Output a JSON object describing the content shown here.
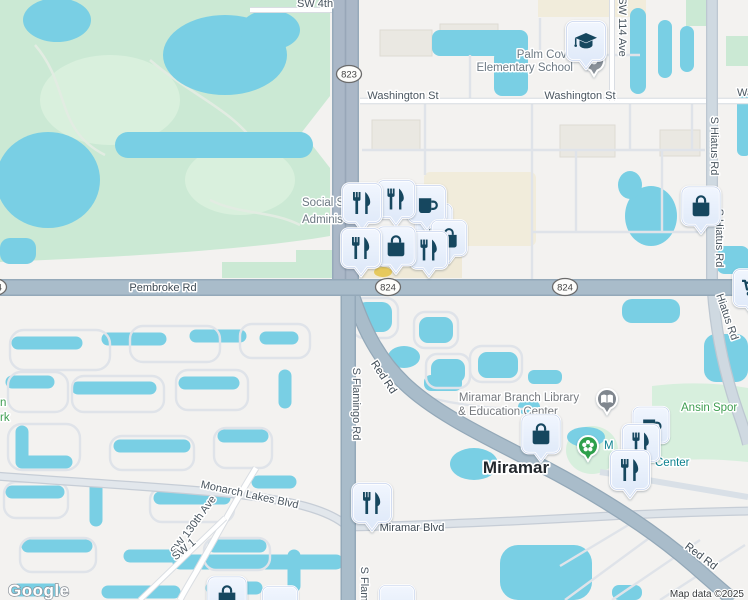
{
  "map": {
    "logo": "Google",
    "attribution": "Map data ©2025",
    "city_label": "Miramar",
    "shields": {
      "route_823": "823",
      "route_824_a": "824",
      "route_824_b": "824",
      "route_824_edge": "824"
    },
    "street_labels": {
      "sw_4th": "SW 4th",
      "washington_st_a": "Washington St",
      "washington_st_b": "Washington St",
      "washington_st_edge": "Was",
      "sw_114_ave": "SW 114 Ave",
      "s_hiatus_rd_a": "S Hiatus Rd",
      "s_hiatus_rd_b": "S Hiatus Rd",
      "hiatus_rd": "Hiatus Rd",
      "pembroke_rd": "Pembroke Rd",
      "s_flamingo_rd": "S Flamingo Rd",
      "s_flamingo_rd_edge": "S Flam",
      "red_rd_a": "Red Rd",
      "red_rd_b": "Red Rd",
      "monarch_lakes_blvd": "Monarch Lakes Blvd",
      "sw_130th_ave": "SW 130th Ave",
      "sw_1_edge": "SW 1",
      "miramar_blvd": "Miramar Blvd"
    },
    "poi_labels": {
      "palm_cove_line1": "Palm Cove",
      "palm_cove_line2": "Elementary School",
      "social_security_line1": "Social Se",
      "social_security_line2": "Adminis",
      "library_line1": "Miramar Branch Library",
      "library_line2": "& Education Center",
      "ansin_edge": "Ansin Spor",
      "center_fragment_m": "M",
      "center_fragment": "Center",
      "park_edge_line1": "n",
      "park_edge_line2": "rk"
    },
    "pin_icons": [
      "restaurant",
      "cafe",
      "gas-station",
      "shopping-bag",
      "shopping-cart",
      "school",
      "library-book",
      "garden-flower"
    ],
    "colors": {
      "water": "#79cfe4",
      "park": "#cbe9d4",
      "road_major": "#a9bcca",
      "pin_background": "#e6eefb",
      "pin_glyph": "#17465f",
      "poi_green": "#3f9e51",
      "poi_teal": "#0d828f"
    }
  }
}
